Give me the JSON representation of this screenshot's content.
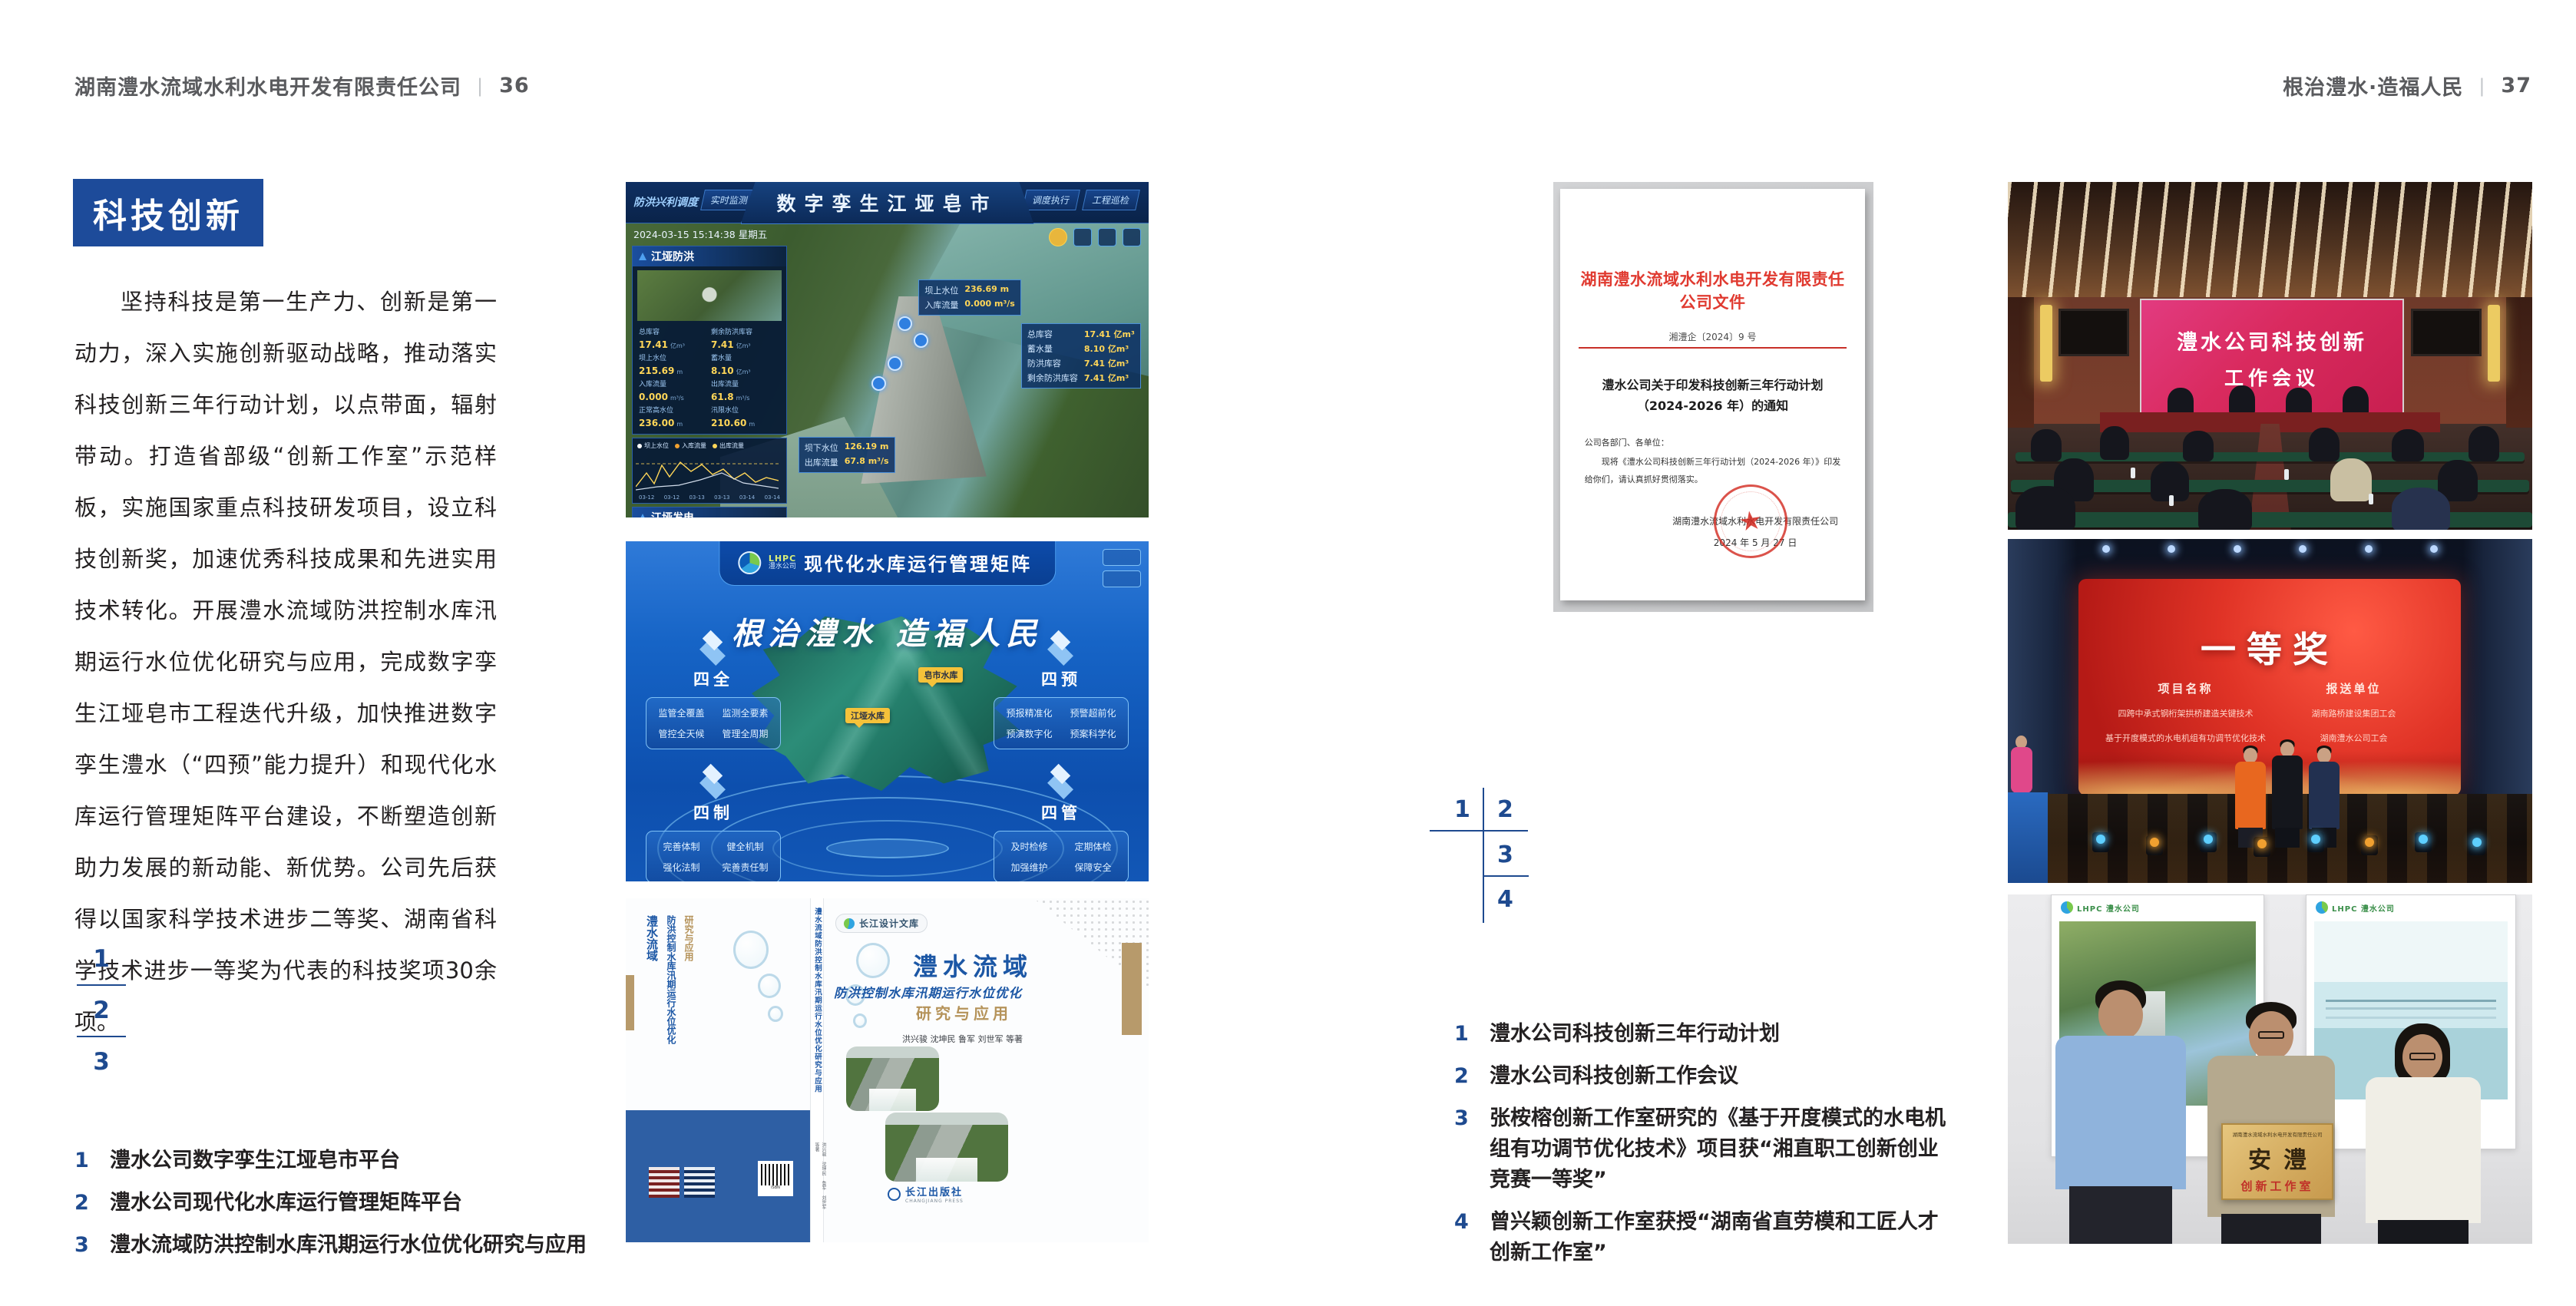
{
  "page_left": {
    "header": {
      "title": "湖南澧水流域水利水电开发有限责任公司",
      "divider": "|",
      "page_no": "36"
    },
    "section_badge": "科技创新",
    "paragraph": "坚持科技是第一生产力、创新是第一动力，深入实施创新驱动战略，推动落实科技创新三年行动计划，以点带面，辐射带动。打造省部级“创新工作室”示范样板，实施国家重点科技研发项目，设立科技创新奖，加速优秀科技成果和先进实用技术转化。开展澧水流域防洪控制水库汛期运行水位优化研究与应用，完成数字孪生江垭皂市工程迭代升级，加快推进数字孪生澧水（“四预”能力提升）和现代化水库运行管理矩阵平台建设，不断塑造创新助力发展的新动能、新优势。公司先后获得以国家科学技术进步二等奖、湖南省科学技术进步一等奖为代表的科技奖项30余项。",
    "figure_index": [
      "1",
      "2",
      "3"
    ],
    "captions": [
      {
        "num": "1",
        "text": "澧水公司数字孪生江垭皂市平台"
      },
      {
        "num": "2",
        "text": "澧水公司现代化水库运行管理矩阵平台"
      },
      {
        "num": "3",
        "text": "澧水流域防洪控制水库汛期运行水位优化研究与应用"
      }
    ]
  },
  "page_right": {
    "header": {
      "title": "根治澧水·造福人民",
      "divider": "|",
      "page_no": "37"
    },
    "figure_index": [
      "1",
      "2",
      "3",
      "4"
    ],
    "captions": [
      {
        "num": "1",
        "text": "澧水公司科技创新三年行动计划"
      },
      {
        "num": "2",
        "text": "澧水公司科技创新工作会议"
      },
      {
        "num": "3",
        "text": "张桉榕创新工作室研究的《基于开度模式的水电机组有功调节优化技术》项目获“湘直职工创新创业竞赛一等奖”"
      },
      {
        "num": "4",
        "text": "曾兴颖创新工作室获授“湖南省直劳模和工匠人才创新工作室”"
      }
    ]
  },
  "fig_digital_twin": {
    "title": "数字孪生江垭皂市",
    "mode_label": "防洪兴利调度",
    "tabs_left": [
      "实时监测",
      "洪水预报",
      "防洪预警"
    ],
    "tabs_right": [
      "暴雨预测",
      "预案生成",
      "调度执行",
      "工程巡检"
    ],
    "timestamp": "2024-03-15 15:14:38 星期五",
    "panel_flood": {
      "title": "江垭防洪",
      "stats": [
        {
          "label": "总库容",
          "value": "17.41",
          "unit": "亿m³"
        },
        {
          "label": "剩余防洪库容",
          "value": "7.41",
          "unit": "亿m³"
        },
        {
          "label": "坝上水位",
          "value": "215.69",
          "unit": "m"
        },
        {
          "label": "蓄水量",
          "value": "8.10",
          "unit": "亿m³"
        },
        {
          "label": "入库流量",
          "value": "0.000",
          "unit": "m³/s"
        },
        {
          "label": "出库流量",
          "value": "61.8",
          "unit": "m³/s"
        },
        {
          "label": "正常高水位",
          "value": "236.00",
          "unit": "m"
        },
        {
          "label": "汛限水位",
          "value": "210.60",
          "unit": "m"
        }
      ]
    },
    "chart_legend": [
      "坝上水位",
      "入库流量",
      "出库流量"
    ],
    "chart_xlabels": [
      "03-12",
      "03-12",
      "03-13",
      "03-13",
      "03-14",
      "03-14"
    ],
    "panel_power": {
      "title": "江垭发电",
      "stats": [
        {
          "label": "年发电计划",
          "value": "6.3000",
          "unit": "亿度"
        },
        {
          "label": "年累计发电量",
          "value": "3.2903",
          "unit": "亿度"
        },
        {
          "label": "月累计发电量",
          "value": "3259.21",
          "unit": "万度"
        },
        {
          "label": "当前出力",
          "value": "0.00",
          "unit": "(MW)"
        },
        {
          "label": "发电流量",
          "value": "0.00",
          "unit": "m³/s"
        },
        {
          "label": "弃水流量",
          "value": "0.00",
          "unit": "m³/s"
        }
      ]
    },
    "tag_upstream": {
      "rows": [
        {
          "label": "坝上水位",
          "value": "236.69 m"
        },
        {
          "label": "入库流量",
          "value": "0.000 m³/s"
        }
      ]
    },
    "tag_storage": {
      "rows": [
        {
          "label": "总库容",
          "value": "17.41 亿m³"
        },
        {
          "label": "蓄水量",
          "value": "8.10 亿m³"
        },
        {
          "label": "防洪库容",
          "value": "7.41 亿m³"
        },
        {
          "label": "剩余防洪库容",
          "value": "7.41 亿m³"
        }
      ]
    },
    "tag_downstream": {
      "rows": [
        {
          "label": "坝下水位",
          "value": "126.19 m"
        },
        {
          "label": "出库流量",
          "value": "67.8 m³/s"
        }
      ]
    }
  },
  "fig_matrix": {
    "logo_acronym": "LHPC",
    "logo_name": "澧水公司",
    "title": "现代化水库运行管理矩阵",
    "slogan": "根治澧水 造福人民",
    "markers": [
      "皂市水库",
      "江垭水库"
    ],
    "modules": [
      {
        "title": "四全",
        "items": [
          "监管全覆盖",
          "监测全要素",
          "管控全天候",
          "管理全周期"
        ]
      },
      {
        "title": "四预",
        "items": [
          "预报精准化",
          "预警超前化",
          "预演数字化",
          "预案科学化"
        ]
      },
      {
        "title": "四制",
        "items": [
          "完善体制",
          "健全机制",
          "强化法制",
          "完善责任制"
        ]
      },
      {
        "title": "四管",
        "items": [
          "及时检修",
          "定期体检",
          "加强维护",
          "保障安全"
        ]
      }
    ]
  },
  "fig_book": {
    "series_badge": "长江设计文库",
    "title_main": "澧水流域",
    "title_sub": "防洪控制水库汛期运行水位优化",
    "title_tail": "研究与应用",
    "authors": "洪兴骏 沈坤民 鲁军 刘世军 等著",
    "publisher": "长江出版社",
    "publisher_en": "CHANGJIANG PRESS",
    "spine_title": "澧水流域防洪控制水库汛期运行水位优化研究与应用",
    "spine_authors": "洪兴骏 沈坤民 鲁军 刘世军 等著",
    "back_title_1": "澧水流域",
    "back_title_2": "防洪控制水库汛期运行水位优化",
    "back_title_3": "研究与应用"
  },
  "fig_document": {
    "red_header": "湖南澧水流域水利水电开发有限责任公司文件",
    "doc_no": "湘澧企〔2024〕9 号",
    "title_line1": "澧水公司关于印发科技创新三年行动计划",
    "title_line2": "（2024-2026 年）的通知",
    "salutation": "公司各部门、各单位：",
    "body": "现将《澧水公司科技创新三年行动计划（2024-2026 年）》印发给你们，请认真抓好贯彻落实。",
    "signer": "湖南澧水流域水利水电开发有限责任公司",
    "sign_date": "2024 年 5 月 27 日"
  },
  "fig_meeting": {
    "screen_line1": "澧水公司科技创新",
    "screen_line2": "工作会议"
  },
  "fig_stage": {
    "award": "一等奖",
    "col1_header": "项目名称",
    "col2_header": "报送单位",
    "projects": [
      "四跨中承式钢桁架拱桥建造关键技术",
      "基于开度模式的水电机组有功调节优化技术"
    ],
    "units": [
      "湖南路桥建设集团工会",
      "湖南澧水公司工会"
    ]
  },
  "fig_plaque": {
    "header": "湖南澧水流域水利水电开发有限责任公司",
    "big_text": "安澧",
    "sub_text": "创新工作室",
    "poster_logo_left": "LHPC 澧水公司",
    "poster_logo_right": "LHPC 澧水公司"
  }
}
